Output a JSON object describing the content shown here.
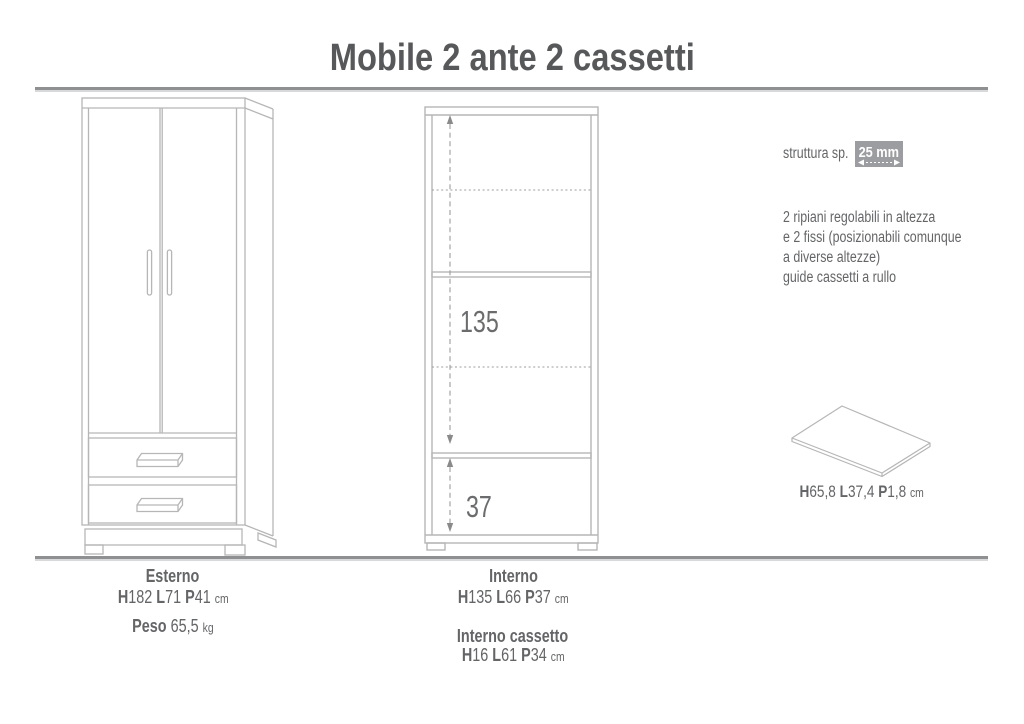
{
  "title": "Mobile 2 ante 2 cassetti",
  "specs": {
    "structure_label": "struttura sp.",
    "structure_value": "25 mm",
    "notes": [
      "2 ripiani regolabili in altezza",
      "e 2 fissi (posizionabili comunque",
      "a diverse altezze)",
      "guide cassetti a rullo"
    ]
  },
  "drawings": {
    "interior": {
      "upper_height": "135",
      "lower_height": "37"
    },
    "shelf_panel": {
      "dims": [
        {
          "k": "H",
          "v": "65,8"
        },
        {
          "k": "L",
          "v": "37,4"
        },
        {
          "k": "P",
          "v": "1,8"
        }
      ],
      "unit": "cm"
    }
  },
  "footer": {
    "esterno": {
      "label": "Esterno",
      "dims": [
        {
          "k": "H",
          "v": "182"
        },
        {
          "k": "L",
          "v": "71"
        },
        {
          "k": "P",
          "v": "41"
        }
      ],
      "unit": "cm",
      "peso_label": "Peso",
      "peso_value": "65,5",
      "peso_unit": "kg"
    },
    "interno": {
      "label": "Interno",
      "dims": [
        {
          "k": "H",
          "v": "135"
        },
        {
          "k": "L",
          "v": "66"
        },
        {
          "k": "P",
          "v": "37"
        }
      ],
      "unit": "cm"
    },
    "interno_cassetto": {
      "label": "Interno cassetto",
      "dims": [
        {
          "k": "H",
          "v": "16"
        },
        {
          "k": "L",
          "v": "61"
        },
        {
          "k": "P",
          "v": "34"
        }
      ],
      "unit": "cm"
    }
  },
  "colors": {
    "line_art": "#b6b6b6",
    "dimension_line": "#9d9d9d",
    "text": "#646567",
    "title_text": "#57585a",
    "badge_background": "#9c9da0",
    "badge_text": "#ffffff",
    "divider": "#8e9092"
  }
}
